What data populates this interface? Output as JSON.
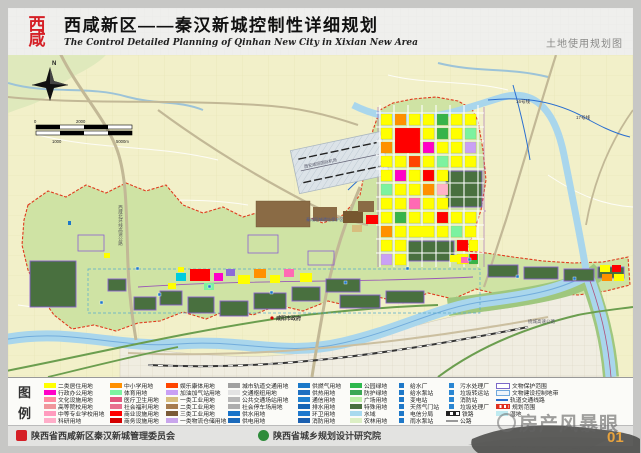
{
  "header": {
    "logo_top": "西",
    "logo_bottom": "咸",
    "title": "西咸新区——秦汉新城控制性详细规划",
    "subtitle": "The Control Detailed Planning of Qinhan New City in Xixian New Area",
    "map_type_label": "土地使用规划图"
  },
  "map": {
    "compass_label": "N",
    "scale_ticks": {
      "t0": "0",
      "t1000": "1000",
      "t2000": "2000",
      "t5000": "5000m"
    },
    "labels": {
      "expressway_west": "西咸北环线高速公路",
      "airport": "西安咸阳国际机场",
      "relic_zone": "秦咸阳城遗址保护区",
      "city_gov": "咸阳市政府",
      "metro_16": "16号线",
      "metro_17": "17号线",
      "ring_expressway": "绕城高速公路"
    }
  },
  "legend": {
    "title_chars": {
      "c1": "图",
      "c2": "例"
    },
    "columns": [
      {
        "items": [
          {
            "label": "二类居住用地",
            "color": "#FFFF00",
            "type": "fill"
          },
          {
            "label": "行政办公用地",
            "color": "#FF00C8",
            "type": "fill"
          },
          {
            "label": "文化设施用地",
            "color": "#FF8CA0",
            "type": "fill"
          },
          {
            "label": "高等院校用地",
            "color": "#F0969B",
            "type": "fill"
          },
          {
            "label": "中等专业学校用地",
            "color": "#FF9BBE",
            "type": "fill"
          },
          {
            "label": "科研用地",
            "color": "#FFAEC9",
            "type": "fill"
          }
        ]
      },
      {
        "items": [
          {
            "label": "中小学用地",
            "color": "#FF9000",
            "type": "fill"
          },
          {
            "label": "体育用地",
            "color": "#7CF2A0",
            "type": "fill"
          },
          {
            "label": "医疗卫生用地",
            "color": "#E1577E",
            "type": "fill"
          },
          {
            "label": "社会福利用地",
            "color": "#E8708F",
            "type": "fill"
          },
          {
            "label": "商业设施用地",
            "color": "#FF0000",
            "type": "fill"
          },
          {
            "label": "商务设施用地",
            "color": "#D40000",
            "type": "fill"
          }
        ]
      },
      {
        "items": [
          {
            "label": "娱乐康体用地",
            "color": "#FF4500",
            "type": "fill"
          },
          {
            "label": "加油加气站用地",
            "color": "#C9A0F5",
            "type": "fill"
          },
          {
            "label": "一类工业用地",
            "color": "#D8BE7E",
            "type": "fill"
          },
          {
            "label": "二类工业用地",
            "color": "#A67B4F",
            "type": "fill"
          },
          {
            "label": "三类工业用地",
            "color": "#7B5B37",
            "type": "fill"
          },
          {
            "label": "一类物流仓储用地",
            "color": "#C9A6EC",
            "type": "fill"
          }
        ]
      },
      {
        "items": [
          {
            "label": "城市轨道交通用地",
            "color": "#A0A0A0",
            "type": "fill"
          },
          {
            "label": "交通枢纽用地",
            "color": "#E3E3E3",
            "type": "fill"
          },
          {
            "label": "公共交通场站用地",
            "color": "#B8B8B8",
            "type": "fill"
          },
          {
            "label": "社会停车场用地",
            "color": "#ADADAD",
            "type": "fill"
          },
          {
            "label": "供水用地",
            "color": "#1873C8",
            "type": "fill"
          },
          {
            "label": "供电用地",
            "color": "#1B6ABB",
            "type": "fill"
          }
        ]
      },
      {
        "items": [
          {
            "label": "供燃气用地",
            "color": "#1A78C8",
            "type": "fill"
          },
          {
            "label": "供热用地",
            "color": "#1E6FC0",
            "type": "fill"
          },
          {
            "label": "通信用地",
            "color": "#2080D0",
            "type": "fill"
          },
          {
            "label": "排水用地",
            "color": "#1565B5",
            "type": "fill"
          },
          {
            "label": "环卫用地",
            "color": "#1E78CD",
            "type": "fill"
          },
          {
            "label": "消防用地",
            "color": "#1C60B0",
            "type": "fill"
          }
        ]
      },
      {
        "items": [
          {
            "label": "公园绿地",
            "color": "#2EB84D",
            "type": "fill"
          },
          {
            "label": "防护绿地",
            "color": "#3CA855",
            "type": "fill"
          },
          {
            "label": "广场用地",
            "color": "#BEF0A8",
            "type": "fill"
          },
          {
            "label": "特殊用地",
            "color": "#49703F",
            "type": "fill"
          },
          {
            "label": "水域",
            "color": "#A8D9EE",
            "type": "fill"
          },
          {
            "label": "农林用地",
            "color": "#DCEFC4",
            "type": "fill"
          }
        ]
      },
      {
        "items": [
          {
            "label": "给水厂",
            "color": "#1E78C8",
            "type": "icon"
          },
          {
            "label": "给水泵站",
            "color": "#1E78C8",
            "type": "icon"
          },
          {
            "label": "变电站",
            "color": "#1E78C8",
            "type": "icon"
          },
          {
            "label": "天然气门站",
            "color": "#1E78C8",
            "type": "icon"
          },
          {
            "label": "电信分局",
            "color": "#1E78C8",
            "type": "icon"
          },
          {
            "label": "雨水泵站",
            "color": "#1E78C8",
            "type": "icon"
          }
        ]
      },
      {
        "items": [
          {
            "label": "污水处理厂",
            "color": "#2A86D2",
            "type": "icon"
          },
          {
            "label": "垃圾转运站",
            "color": "#2A86D2",
            "type": "icon"
          },
          {
            "label": "消防站",
            "color": "#2A86D2",
            "type": "icon"
          },
          {
            "label": "垃圾处理厂",
            "color": "#2A86D2",
            "type": "icon"
          },
          {
            "label": "铁路",
            "color": "#222222",
            "type": "rail"
          },
          {
            "label": "公路",
            "color": "#999999",
            "type": "road"
          }
        ]
      },
      {
        "items": [
          {
            "label": "文物保护范围",
            "color": "#7B68C8",
            "type": "outline"
          },
          {
            "label": "文物建设控制地带",
            "color": "#6FA8DC",
            "type": "outline2"
          },
          {
            "label": "轨道交通线路",
            "color": "#2A6FD0",
            "type": "line"
          },
          {
            "label": "规划范围",
            "color": "#E03020",
            "type": "dashred"
          },
          {
            "label": "湿地",
            "color": "#BFEAF0",
            "type": "fill"
          }
        ]
      }
    ]
  },
  "footer": {
    "org1": "陕西省西咸新区秦汉新城管理委员会",
    "org2": "陕西省城乡规划设计研究院",
    "watermark": "房产风暴眼",
    "page_number": "01"
  }
}
